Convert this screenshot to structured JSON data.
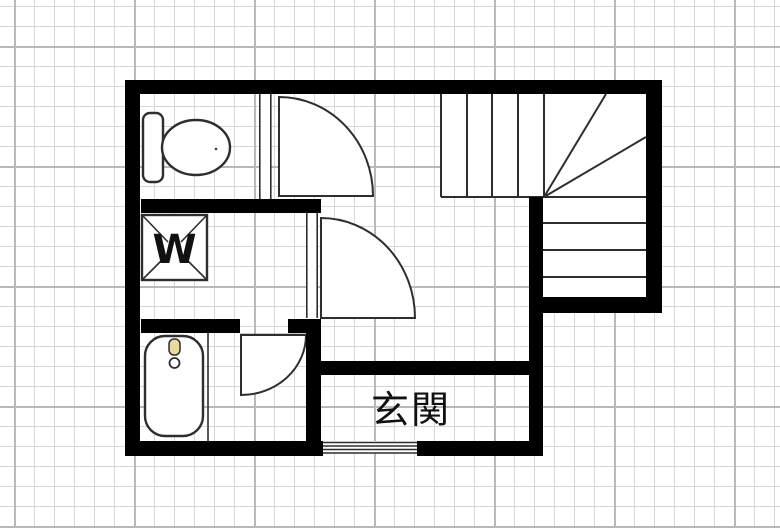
{
  "plan": {
    "type": "floor-plan",
    "labels": {
      "entrance": "玄関",
      "washing_machine": "W"
    },
    "icons": [
      "toilet-icon",
      "washing-machine-icon",
      "bathtub-icon",
      "staircase-icon",
      "door-swing-icon",
      "entrance-sliding-door-icon"
    ],
    "colors": {
      "wall": "#000000",
      "line": "#2e2e2e",
      "grid_minor": "#d7d7d7",
      "grid_major": "#b9b9b9",
      "background": "#ffffff",
      "faucet_accent": "#e9d9a0",
      "label_text": "#111111"
    }
  }
}
